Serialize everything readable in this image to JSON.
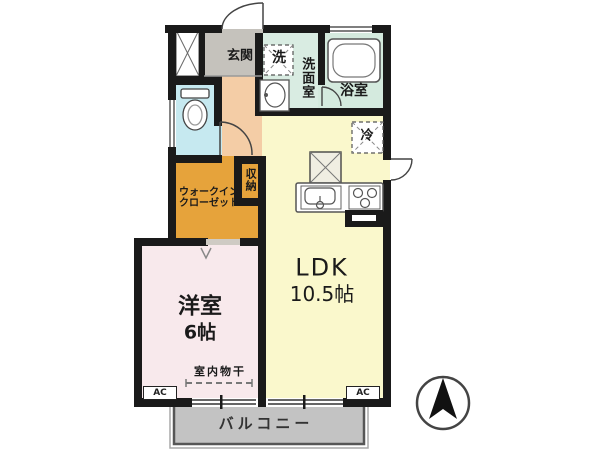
{
  "page": {
    "type": "japanese-apartment-floor-plan"
  },
  "labels": {
    "genkan": "玄関",
    "washer": "洗",
    "washroom": "洗面室",
    "bath": "浴室",
    "fridge": "冷",
    "storage": "収納",
    "wic_line1": "ウォークイン",
    "wic_line2": "クローゼット",
    "ldk": "LDK",
    "ldk_size": "10.5帖",
    "western": "洋室",
    "western_size": "6帖",
    "drying": "室内物干",
    "ac": "AC",
    "balcony": "バルコニー"
  },
  "colors": {
    "wall": "#1a1a1a",
    "genkan": "#c5c2bc",
    "hallway": "#f4cda6",
    "toilet": "#c6e9f0",
    "washroom": "#d9ece2",
    "bath": "#d4eade",
    "ldk": "#faf8cc",
    "western": "#f8e9ec",
    "closet": "#e6a33b",
    "balcony": "#c3c3c3"
  },
  "icons": {
    "compass": "north-arrow",
    "toilet": "toilet-bowl",
    "bathtub": "bathtub",
    "vanity": "vanity-sink",
    "kitchen": "kitchen-sink-and-stove",
    "appliance_boxes": "dashed-square-with-x"
  }
}
